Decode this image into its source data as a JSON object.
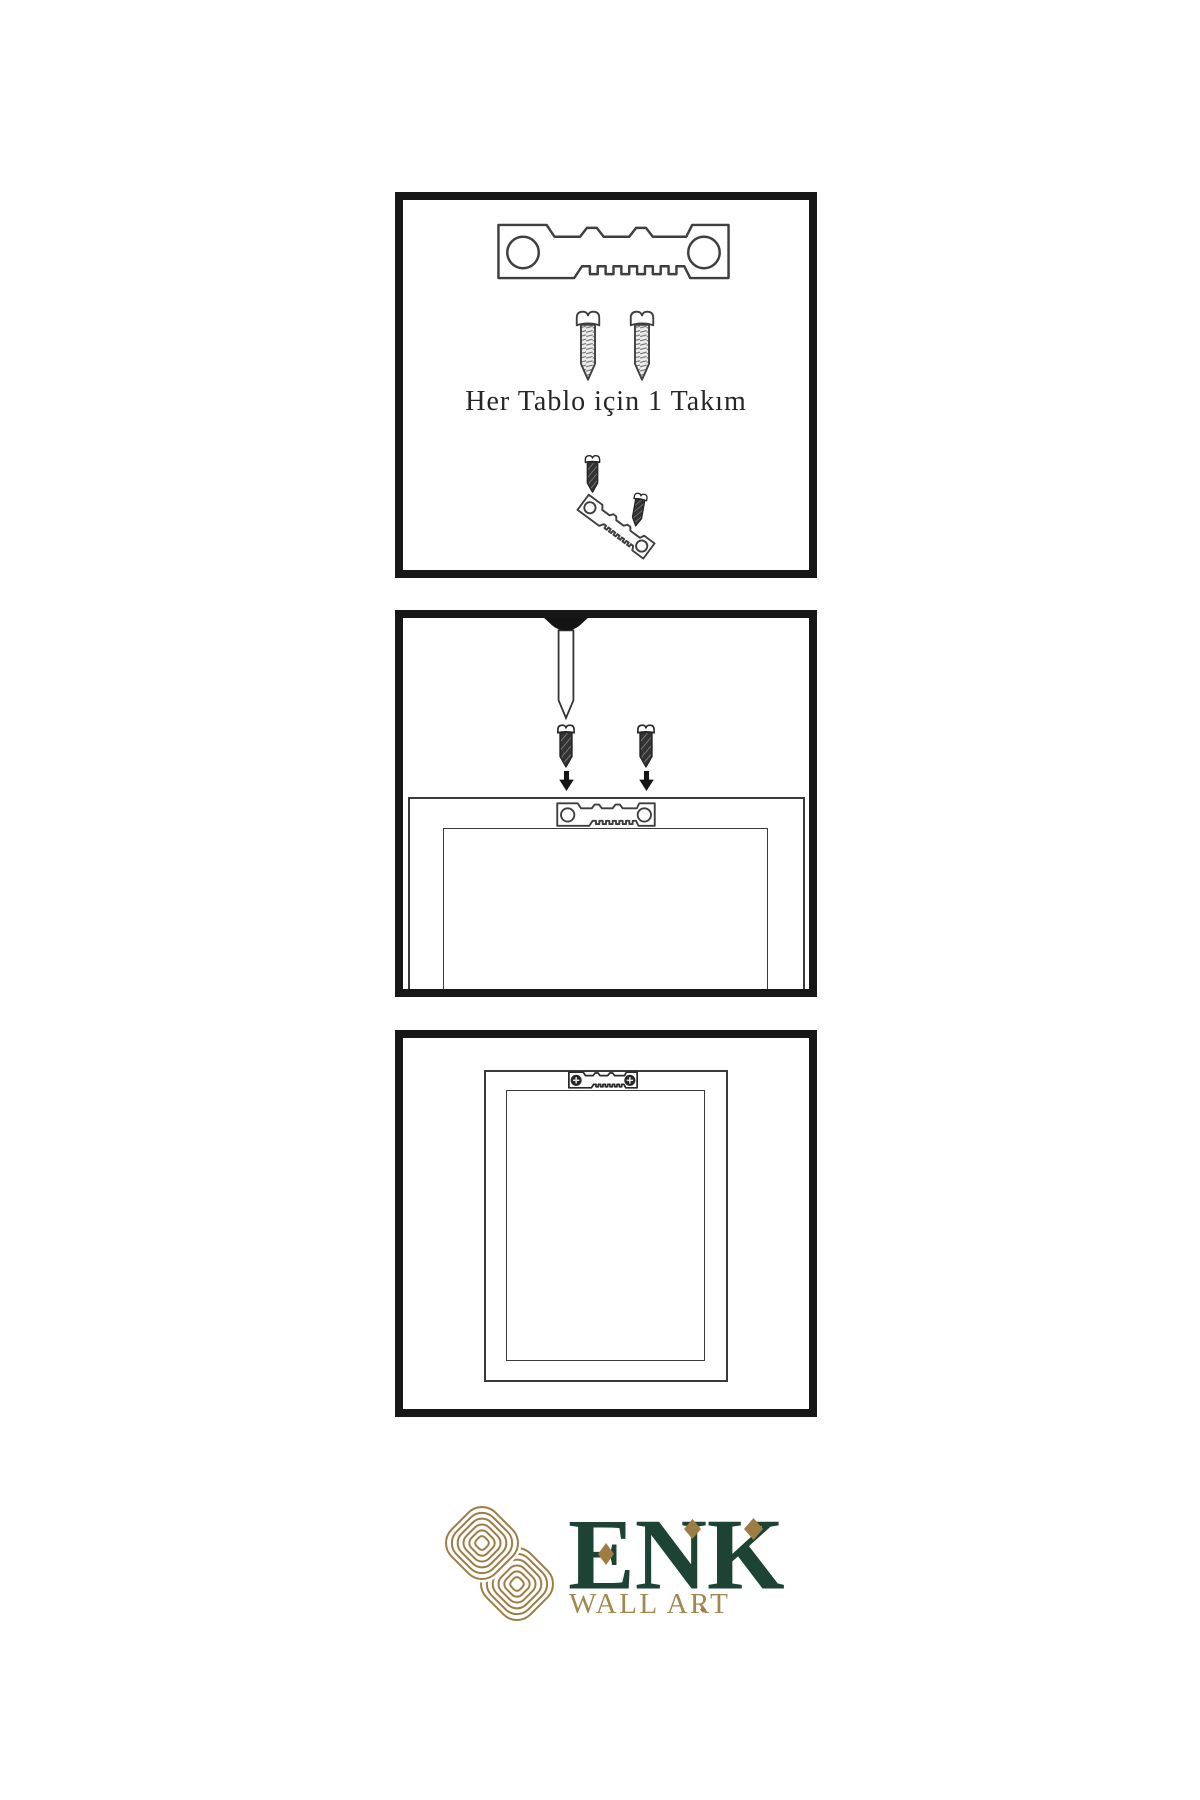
{
  "colors": {
    "background": "#ffffff",
    "panel_border": "#171717",
    "line_art": "#3f3f3f",
    "dark_hardware": "#262626",
    "brand_green": "#1d4334",
    "brand_gold": "#9d7d44",
    "brand_tan": "#a3874f"
  },
  "step1": {
    "caption": "Her Tablo için 1 Takım",
    "icons": [
      "sawtooth-hanger",
      "screw",
      "screw",
      "hanger-assembly-preview"
    ]
  },
  "step2": {
    "icons": [
      "wall-nail",
      "dark-screw",
      "dark-screw",
      "down-arrow",
      "down-arrow",
      "frame-back-with-sawtooth-hanger"
    ]
  },
  "step3": {
    "icons": [
      "hanging-frame",
      "mounted-hanger-with-crosshead-screws"
    ]
  },
  "logo": {
    "brand": "ENK",
    "tagline": "WALL ART",
    "icon": "interlocking-knot"
  }
}
